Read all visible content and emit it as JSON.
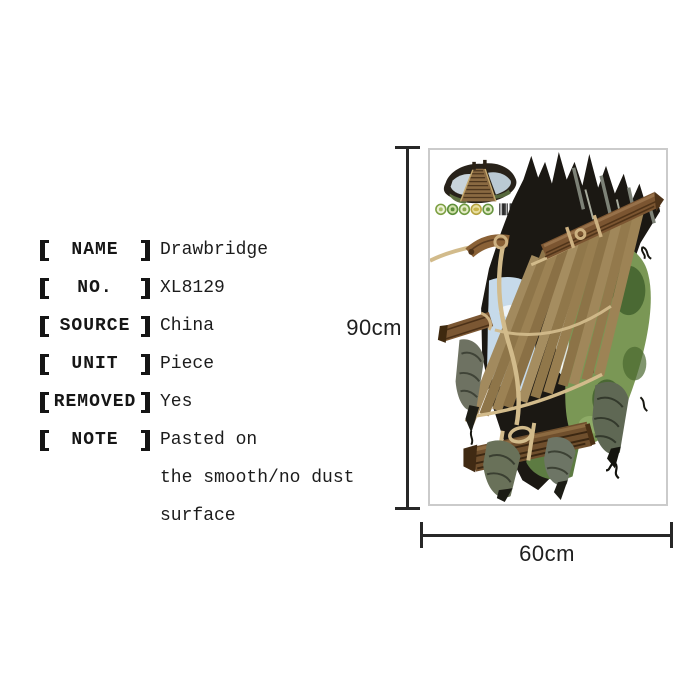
{
  "specs": {
    "rows": [
      {
        "label": "NAME",
        "value": "Drawbridge"
      },
      {
        "label": "NO.",
        "value": "XL8129"
      },
      {
        "label": "SOURCE",
        "value": "China"
      },
      {
        "label": "UNIT",
        "value": "Piece"
      },
      {
        "label": "REMOVED",
        "value": "Yes"
      },
      {
        "label": "NOTE",
        "value": "Pasted on"
      }
    ],
    "note_extra_lines": [
      "the smooth/no dust",
      "surface"
    ]
  },
  "diagram": {
    "height_label": "90cm",
    "width_label": "60cm",
    "line_color": "#272727"
  },
  "product_image": {
    "subject": "3D drawbridge wall sticker in torn floor hole",
    "icons": [
      "sticker-thumbnail",
      "badge-icon",
      "badge-icon",
      "badge-icon",
      "badge-icon",
      "badge-icon",
      "barcode-icon"
    ],
    "frame_border_color": "#cbcbcb",
    "artwork_colors": {
      "hole_dark": "#1b1813",
      "plank_brown": "#9a8154",
      "log_brown": "#6f4f2d",
      "rope_tan": "#d2bb8b",
      "foliage_green": "#7a9755",
      "sky_blue": "#c6daea",
      "torn_gray": "#6e7262"
    }
  },
  "text_color": "#1a1a1a"
}
